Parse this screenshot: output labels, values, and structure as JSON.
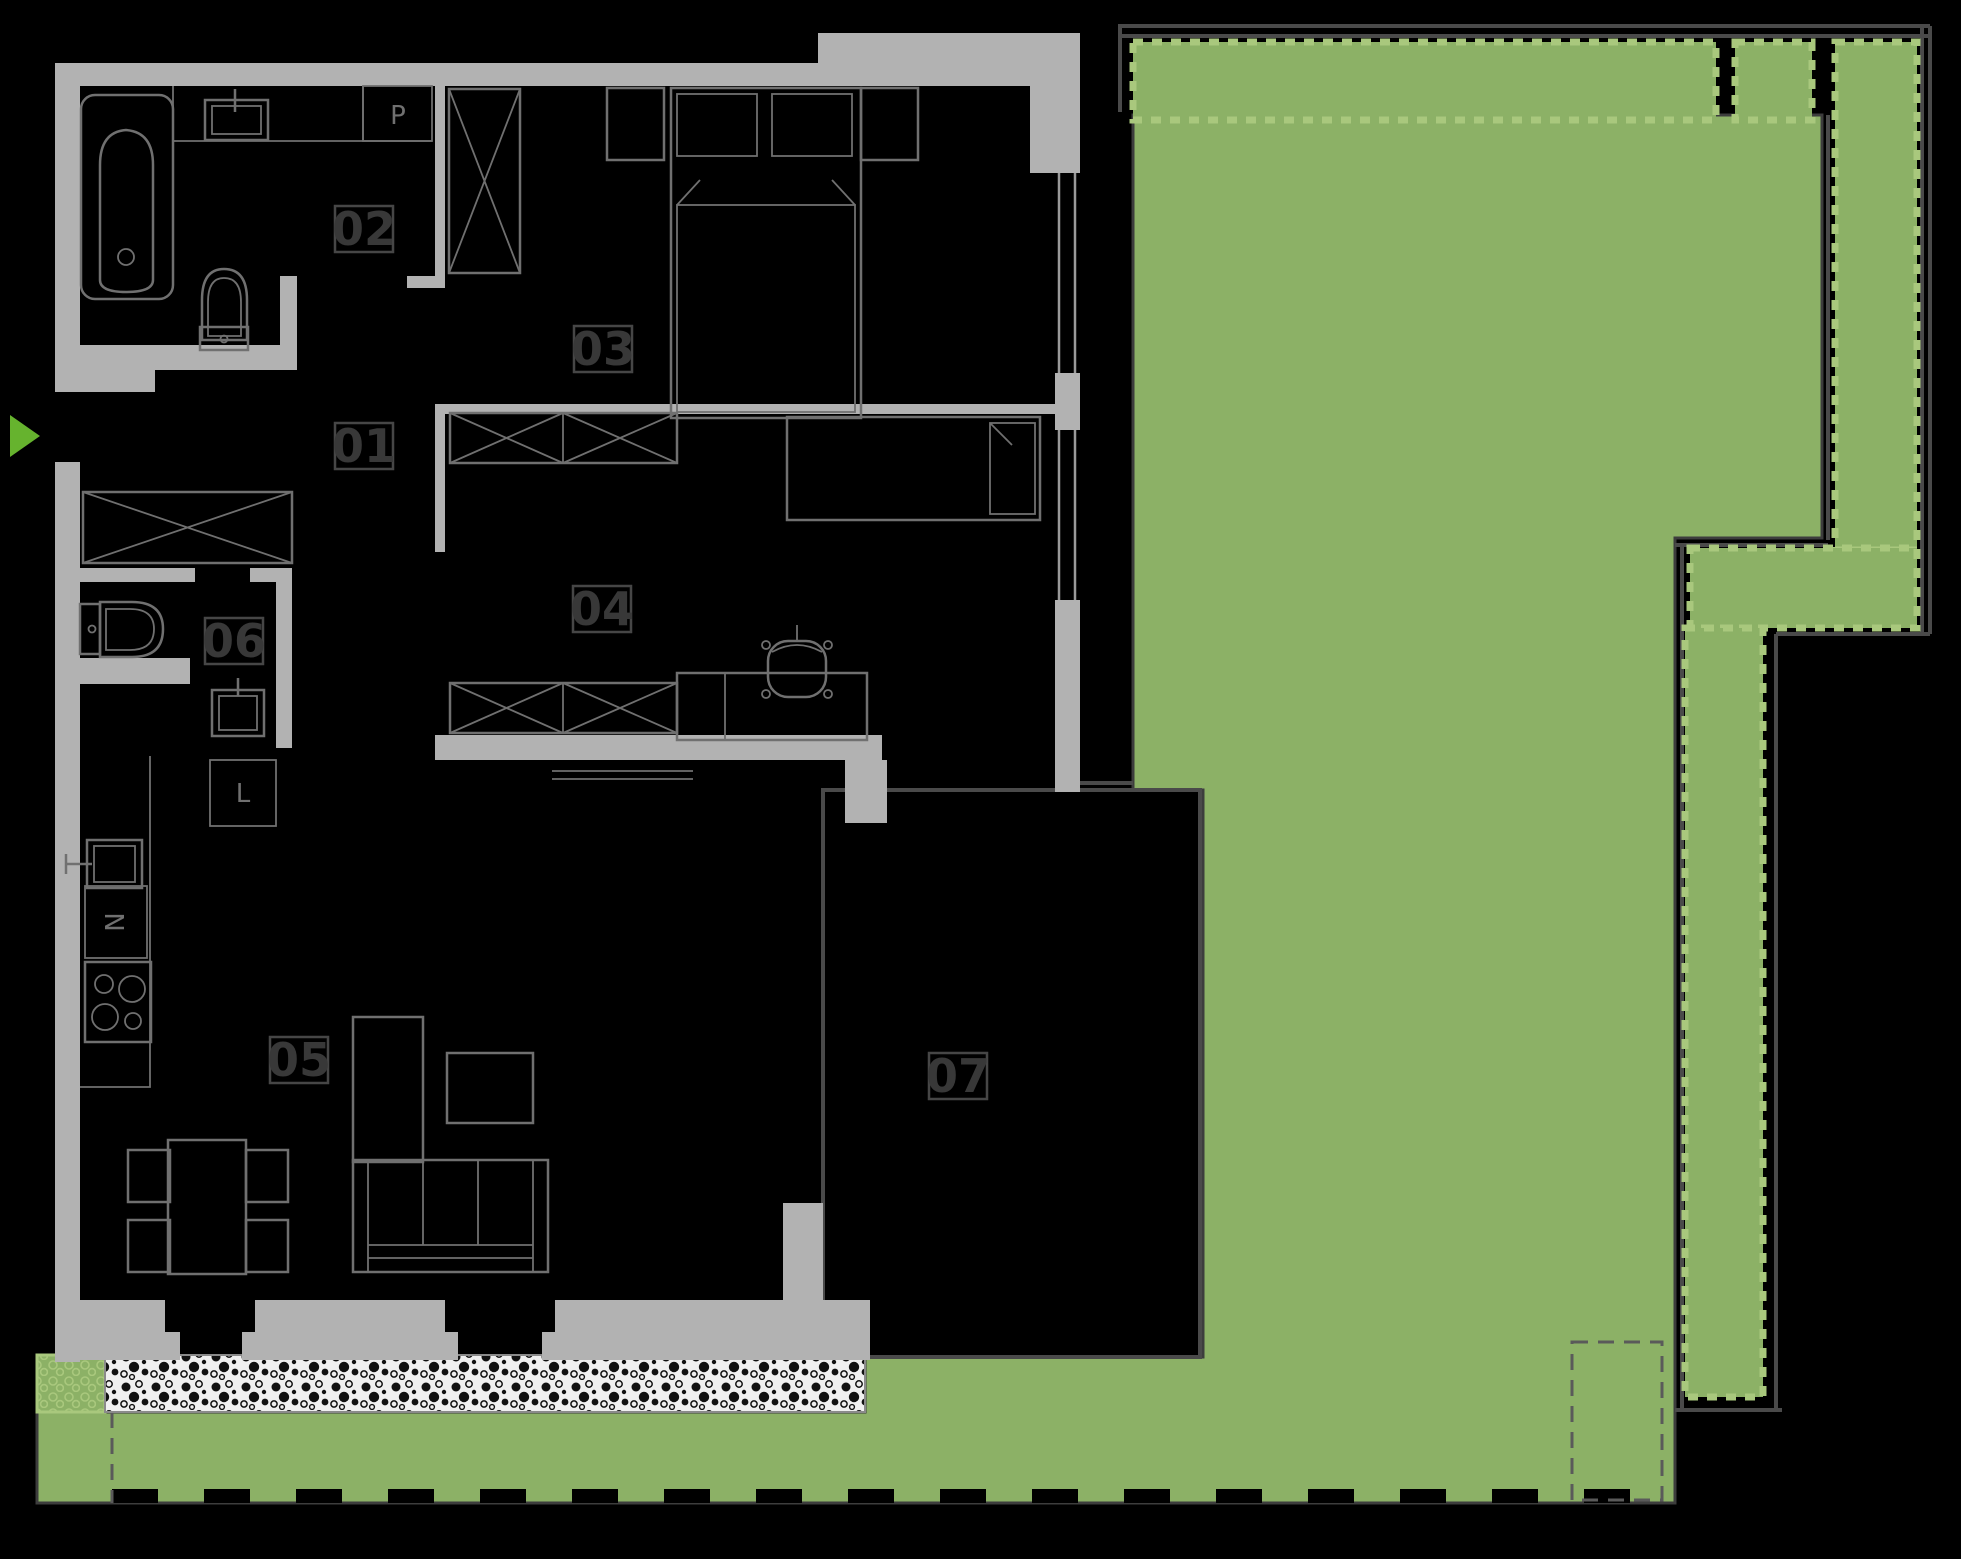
{
  "floorplan": {
    "rooms": [
      {
        "number": "01"
      },
      {
        "number": "02"
      },
      {
        "number": "03"
      },
      {
        "number": "04"
      },
      {
        "number": "05"
      },
      {
        "number": "06"
      },
      {
        "number": "07"
      }
    ],
    "appliance_labels": {
      "washing_machine": "P",
      "oven": "N",
      "fridge": "L"
    },
    "colors": {
      "background": "#000000",
      "wall": "#b2b2b2",
      "furniture_line": "#707070",
      "room_label_text": "#383838",
      "room_label_border": "#464646",
      "garden_green": "#8cb166",
      "hedge_border_green": "#a9c87d",
      "entrance_arrow_green": "#66b32e",
      "plot_boundary_line": "#4a4a4a",
      "paving_background": "#f0f0f0",
      "paving_dots": "#111111"
    }
  }
}
